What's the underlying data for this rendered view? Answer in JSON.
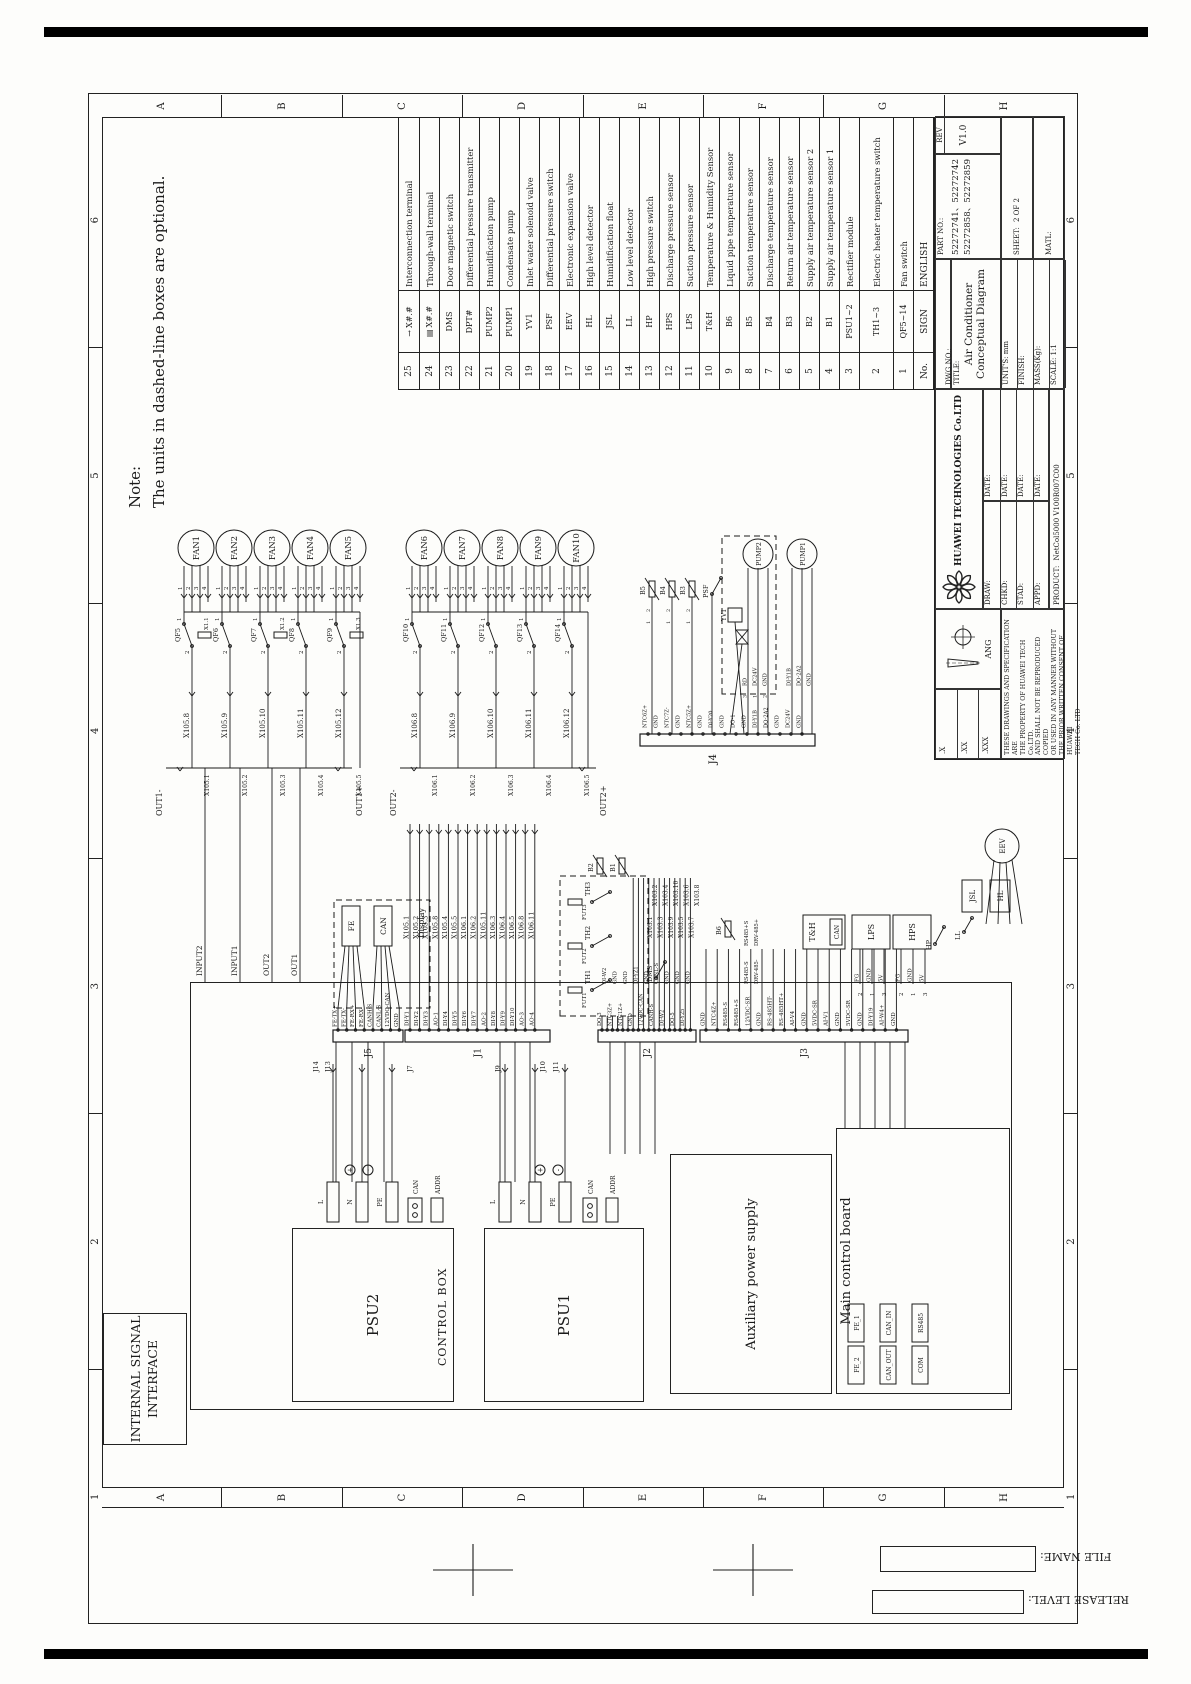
{
  "note": {
    "heading": "Note:",
    "text": "The units in dashed-line boxes are optional."
  },
  "frame": {
    "zone_letters": [
      "A",
      "B",
      "C",
      "D",
      "E",
      "F",
      "G",
      "H"
    ],
    "zone_numbers": [
      "1",
      "2",
      "3",
      "4",
      "5",
      "6"
    ],
    "file_name_label": "FILE NAME:",
    "release_level_label": "RELEASE LEVEL:"
  },
  "legend": {
    "headers": {
      "no": "No.",
      "sign": "SIGN",
      "english": "ENGLISH"
    },
    "rows": [
      {
        "no": "25",
        "icon": "arrow",
        "sign": "X#.#",
        "english": "Interconnection terminal"
      },
      {
        "no": "24",
        "icon": "block",
        "sign": "X#.#",
        "english": "Through-wall terminal"
      },
      {
        "no": "23",
        "icon": "",
        "sign": "DMS",
        "english": "Door magnetic switch"
      },
      {
        "no": "22",
        "icon": "",
        "sign": "DPT#",
        "english": "Differential pressure transmitter"
      },
      {
        "no": "21",
        "icon": "",
        "sign": "PUMP2",
        "english": "Humidification pump"
      },
      {
        "no": "20",
        "icon": "",
        "sign": "PUMP1",
        "english": "Condensate pump"
      },
      {
        "no": "19",
        "icon": "",
        "sign": "YV1",
        "english": "Inlet water solenoid valve"
      },
      {
        "no": "18",
        "icon": "",
        "sign": "PSF",
        "english": "Differential pressure switch"
      },
      {
        "no": "17",
        "icon": "",
        "sign": "EEV",
        "english": "Electronic expansion valve"
      },
      {
        "no": "16",
        "icon": "",
        "sign": "HL",
        "english": "High level detector"
      },
      {
        "no": "15",
        "icon": "",
        "sign": "JSL",
        "english": "Humidification float"
      },
      {
        "no": "14",
        "icon": "",
        "sign": "LL",
        "english": "Low level detector"
      },
      {
        "no": "13",
        "icon": "",
        "sign": "HP",
        "english": "High pressure switch"
      },
      {
        "no": "12",
        "icon": "",
        "sign": "HPS",
        "english": "Discharge pressure sensor"
      },
      {
        "no": "11",
        "icon": "",
        "sign": "LPS",
        "english": "Suction pressure sensor"
      },
      {
        "no": "10",
        "icon": "",
        "sign": "T&H",
        "english": "Temperature & Humidity Sensor"
      },
      {
        "no": "9",
        "icon": "",
        "sign": "B6",
        "english": "Liquid pipe temperature sensor"
      },
      {
        "no": "8",
        "icon": "",
        "sign": "B5",
        "english": "Suction temperature sensor"
      },
      {
        "no": "7",
        "icon": "",
        "sign": "B4",
        "english": "Discharge temperature sensor"
      },
      {
        "no": "6",
        "icon": "",
        "sign": "B3",
        "english": "Return air temperature sensor"
      },
      {
        "no": "5",
        "icon": "",
        "sign": "B2",
        "english": "Supply air temperature sensor 2"
      },
      {
        "no": "4",
        "icon": "",
        "sign": "B1",
        "english": "Supply air temperature sensor 1"
      },
      {
        "no": "3",
        "icon": "",
        "sign": "PSU1~2",
        "english": "Rectifier module"
      },
      {
        "no": "2",
        "icon": "",
        "sign": "TH1~3",
        "english": "Electric heater temperature switch"
      },
      {
        "no": "1",
        "icon": "",
        "sign": "QF5~14",
        "english": "Fan switch"
      }
    ]
  },
  "title_block": {
    "company": "HUAWEI TECHNOLOGIES Co.LTD",
    "title_label": "TITLE:",
    "title": "Air Conditioner Conceptual Diagram",
    "dwg_no_label": "DWG NO.:",
    "part_no_label": "PART NO.:",
    "part_no_line1": "52272741、52272742",
    "part_no_line2": "52272858、52272859",
    "rev_label": "REV",
    "rev": "V1.0",
    "units_label": "UNIT'S:",
    "units": "mm",
    "finish_label": "FINISH:",
    "mass_label": "MASS(Kg):",
    "scale_label": "SCALE:",
    "scale": "1:1",
    "sheet_label": "SHEET:",
    "sheet": "2 OF 2",
    "matl_label": "MATL:",
    "product_label": "PRODUCT:",
    "product": "NetCol5000 V100R007C00",
    "ang_label": "ANG",
    "sign_rows": [
      "DRAW:",
      "CHKD:",
      "STAD:",
      "APPD:"
    ],
    "date_label": "DATE:",
    "tolerances": [
      ".X",
      ".XX",
      ".XXX"
    ],
    "notice_lines": [
      "THESE DRAWINGS AND SPECIFICATION ARE",
      "THE PROPERTY OF HUAWEI TECH Co.LTD.",
      "AND SHALL NOT BE REPRODUCED COPIED",
      "OR USED IN ANY MANNER WITHOUT",
      "THE PRIOR WRITTEN CONSENT OF HUAWEI",
      "TECH Co. LTD"
    ]
  },
  "control": {
    "isi_lines": [
      "INTERNAL SIGNAL",
      "INTERFACE"
    ],
    "control_box": "CONTROL BOX",
    "psu2": "PSU2",
    "psu1": "PSU1",
    "aux": "Auxiliary power supply",
    "mcb": "Main control board",
    "psu_terminals": [
      "L",
      "N",
      "PE"
    ],
    "psu_sub": [
      "CAN",
      "ADDR"
    ],
    "polarity": [
      "+",
      "-"
    ],
    "mcb_ports": [
      [
        "FE_2",
        "FE_1"
      ],
      [
        "CAN_OUT",
        "CAN_IN"
      ],
      [
        "COM",
        "RS485"
      ]
    ],
    "io": [
      "INPUT2",
      "INPUT1",
      "OUT2",
      "OUT1"
    ],
    "aux_connectors": [
      "J14",
      "J13",
      "J7",
      "J9",
      "J10",
      "J11"
    ]
  },
  "fans": {
    "pins": [
      "1",
      "2",
      "3",
      "4"
    ],
    "g1": {
      "fans": [
        "FAN1",
        "FAN2",
        "FAN3",
        "FAN4",
        "FAN5"
      ],
      "qf": [
        "QF5",
        "QF6",
        "QF7",
        "QF8",
        "QF9"
      ],
      "fuses": [
        "X1.1",
        "X1.2",
        "X1.3"
      ],
      "terms": [
        "X105.8",
        "X105.9",
        "X105.10",
        "X105.11",
        "X105.12"
      ],
      "rail": [
        "X105.1",
        "X105.2",
        "X105.3",
        "X105.4",
        "X105.5"
      ],
      "out_neg": "OUT1-",
      "out_pos": "OUT1+"
    },
    "g2": {
      "fans": [
        "FAN6",
        "FAN7",
        "FAN8",
        "FAN9",
        "FAN10"
      ],
      "qf": [
        "QF10",
        "QF11",
        "QF12",
        "QF13",
        "QF14"
      ],
      "terms": [
        "X106.8",
        "X106.9",
        "X106.10",
        "X106.11",
        "X106.12"
      ],
      "rail": [
        "X106.1",
        "X106.2",
        "X106.3",
        "X106.4",
        "X106.5"
      ],
      "out_neg": "OUT2-",
      "out_pos": "OUT2+"
    }
  },
  "connectors": {
    "j5": {
      "label": "J5",
      "signals": [
        "FE-TX+",
        "FE-TX-",
        "FE-RX+",
        "FE-RX-",
        "CANH-S",
        "CANL-S",
        "12VDC-CAN",
        "GND"
      ]
    },
    "j1": {
      "label": "J1",
      "signals": [
        "DI-Y1",
        "DI-Y2",
        "DI-Y3",
        "AO-1",
        "DI-Y4",
        "DI-Y5",
        "DI-Y6",
        "DI-Y7",
        "AO-2",
        "DI-Y8",
        "DI-Y9",
        "DI-Y10",
        "AO-3",
        "AO-4"
      ],
      "wires": [
        "X105.1",
        "X105.2",
        "X105.3",
        "X105.8",
        "X105.4",
        "X105.5",
        "X106.1",
        "X106.2",
        "X105.11",
        "X106.3",
        "X106.4",
        "X106.5",
        "X106.8",
        "X106.11"
      ]
    },
    "j2": {
      "label": "J2",
      "signals": [
        "DO-3",
        "DI-W2",
        "NTC3Z+",
        "GND",
        "NTC1Z+",
        "GND",
        "GND",
        "DI-YZ1",
        "12VDC-CAN",
        "GND",
        "CANH-S",
        "CANL-S",
        "DI-W2",
        "GND",
        "DO-5",
        "GND",
        "DI-Y25",
        "GND"
      ],
      "wires": [
        "X103.1",
        "X103.2",
        "X103.3",
        "X103.4",
        "X103.9",
        "X103.10",
        "X103.5",
        "X103.6",
        "X103.7",
        "X103.8"
      ]
    },
    "j3": {
      "label": "J3",
      "signals": [
        "GND",
        "NTC4Z+",
        "RS485-S",
        "RS485+S",
        "12VDC-SR",
        "GND",
        "RS-485HT-",
        "RS-485HT+",
        "AI-V4",
        "GND",
        "5VDC-SR",
        "AI-V1",
        "GND",
        "5VDC-SR",
        "GND",
        "DI-Y19",
        "AI-W4+",
        "GND"
      ]
    },
    "j4": {
      "label": "J4",
      "signals": [
        "NTC6Z+",
        "GND",
        "NTC7Z-",
        "GND",
        "NTC5Z+",
        "GND",
        "DI-Y20",
        "GND",
        "DO-1",
        "GND",
        "DI-Y1B",
        "DO-2A2",
        "GND",
        "DC24V",
        "GND"
      ]
    }
  },
  "components": {
    "display": {
      "label": "Display",
      "fe": "FE",
      "can": "CAN"
    },
    "heater": {
      "fuses": [
        "FUT1",
        "FUT2",
        "FUT3"
      ],
      "switches": [
        "TH1",
        "TH2",
        "TH3"
      ]
    },
    "b12": [
      "B2",
      "B1"
    ],
    "dms": "DMS",
    "b6": "B6",
    "th": {
      "label": "T&H",
      "can": "CAN"
    },
    "lps": {
      "label": "LPS",
      "pins": [
        "FG",
        "GND",
        "5V"
      ],
      "nums": [
        "2",
        "1",
        "3"
      ]
    },
    "hps": {
      "label": "HPS",
      "pins": [
        "FG",
        "GND",
        "5V"
      ],
      "nums": [
        "2",
        "1",
        "3"
      ]
    },
    "hp": "HP",
    "floats": [
      "LL",
      "JSL",
      "HL"
    ],
    "eev": "EEV",
    "b345": [
      "B5",
      "B4",
      "B3"
    ],
    "psf": "PSF",
    "yv1": "YV1",
    "pumps": [
      "PUMP2",
      "PUMP1"
    ],
    "pump2_pins": [
      "3",
      "1",
      "2"
    ],
    "pump2_sig": [
      "RD",
      "DC24V",
      "GND"
    ],
    "pump1_sig": [
      "DI-Y1B",
      "DO-2A2",
      "GND"
    ],
    "rs485": [
      "RS485-S",
      "RS485+S",
      "DRV-485-",
      "DRV-485+"
    ]
  }
}
